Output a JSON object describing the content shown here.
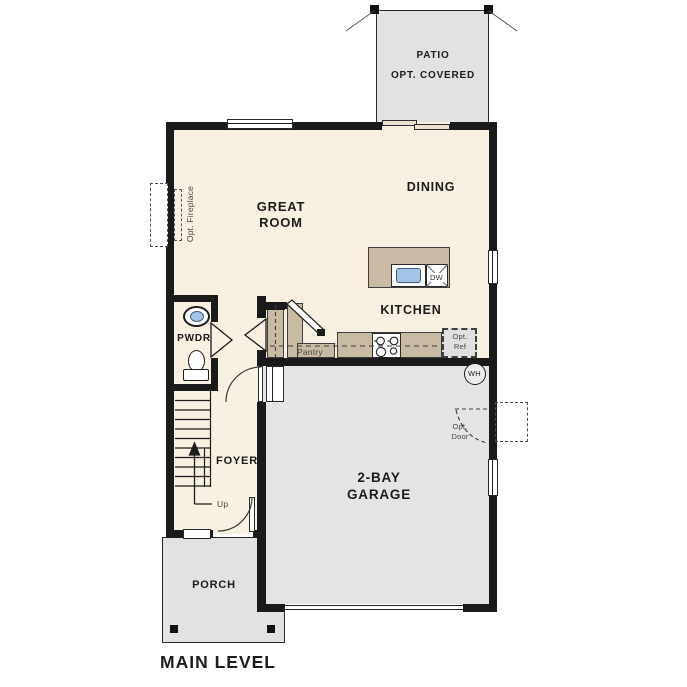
{
  "page_title": "MAIN LEVEL",
  "colors": {
    "wall": "#1a1a1a",
    "interior_floor": "#f8f0e1",
    "garage_patio_floor": "#e4e4e4",
    "cabinet_tan": "#c9bba2",
    "sink_blue": "#a3c6e8"
  },
  "rooms": {
    "patio": {
      "name": "PATIO",
      "note": "OPT. COVERED"
    },
    "great_room": {
      "line1": "GREAT",
      "line2": "ROOM"
    },
    "dining": "DINING",
    "kitchen": "KITCHEN",
    "powder": "PWDR",
    "foyer": "FOYER",
    "garage": {
      "line1": "2-BAY",
      "line2": "GARAGE"
    },
    "porch": "PORCH"
  },
  "annotations": {
    "opt_fireplace": "Opt. Fireplace",
    "pantry": "Pantry",
    "opt_ref": {
      "line1": "Opt.",
      "line2": "Ref"
    },
    "opt_door": {
      "line1": "Opt.",
      "line2": "Door"
    },
    "stairs_up": "Up",
    "water_heater": "WH",
    "dishwasher": "DW"
  }
}
